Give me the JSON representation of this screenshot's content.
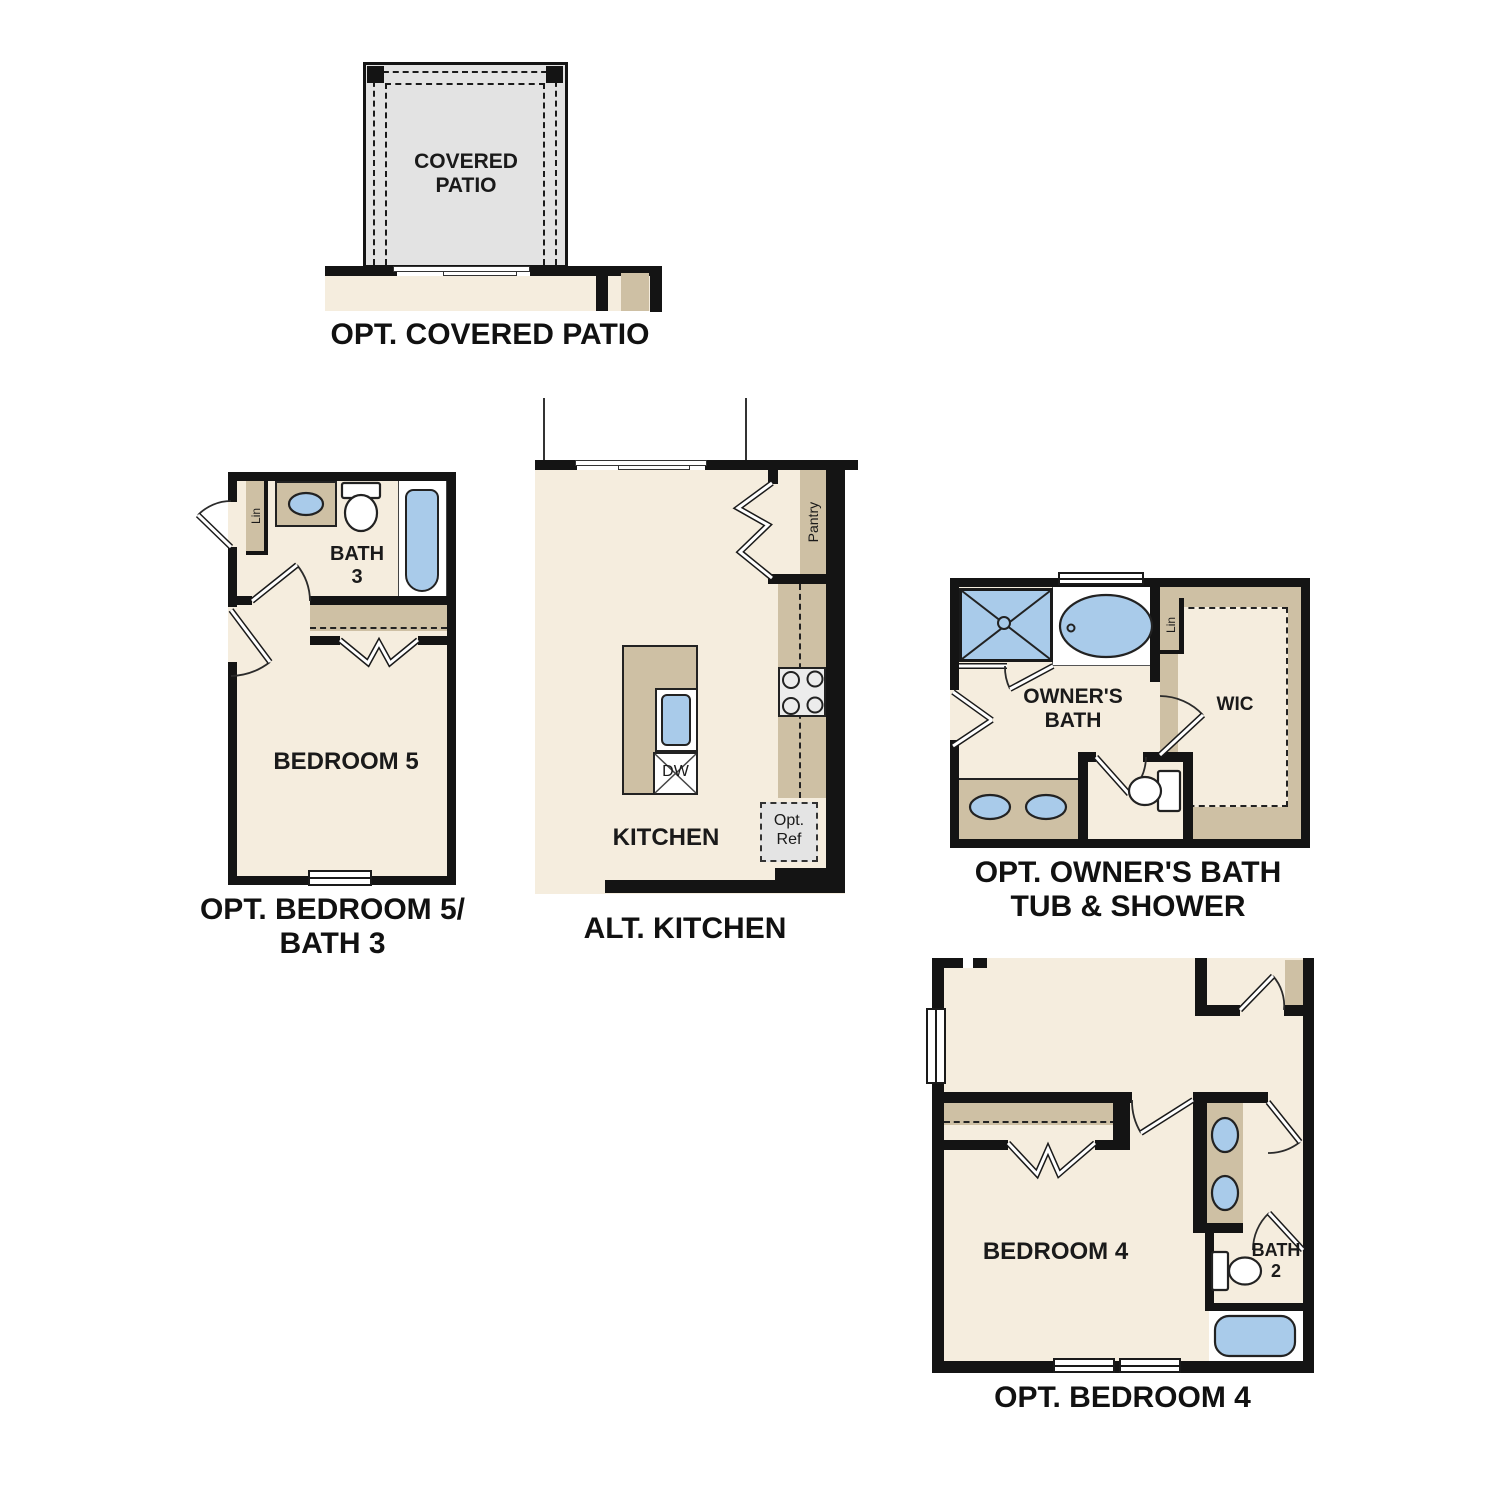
{
  "colors": {
    "wall": "#141414",
    "floor": "#f5edde",
    "cabinet_tan": "#cec0a4",
    "patio_gray": "#e3e3e3",
    "fixture_blue": "#a9cbea",
    "appliance_gray": "#ececec",
    "label_text": "#1a1a1a"
  },
  "plans": {
    "covered_patio": {
      "title": "OPT. COVERED PATIO",
      "room_label": "COVERED\nPATIO"
    },
    "bedroom5_bath3": {
      "title": "OPT. BEDROOM 5/\nBATH 3",
      "bedroom_label": "BEDROOM 5",
      "bath_label": "BATH\n3",
      "linen_label": "Lin"
    },
    "alt_kitchen": {
      "title": "ALT. KITCHEN",
      "room_label": "KITCHEN",
      "pantry_label": "Pantry",
      "dishwasher_label": "DW",
      "optional_fridge_label": "Opt.\nRef"
    },
    "owners_bath": {
      "title": "OPT. OWNER'S BATH\nTUB & SHOWER",
      "room_label": "OWNER'S\nBATH",
      "closet_label": "WIC",
      "linen_label": "Lin"
    },
    "bedroom4": {
      "title": "OPT. BEDROOM 4",
      "room_label": "BEDROOM 4",
      "bath_label": "BATH\n2"
    }
  }
}
